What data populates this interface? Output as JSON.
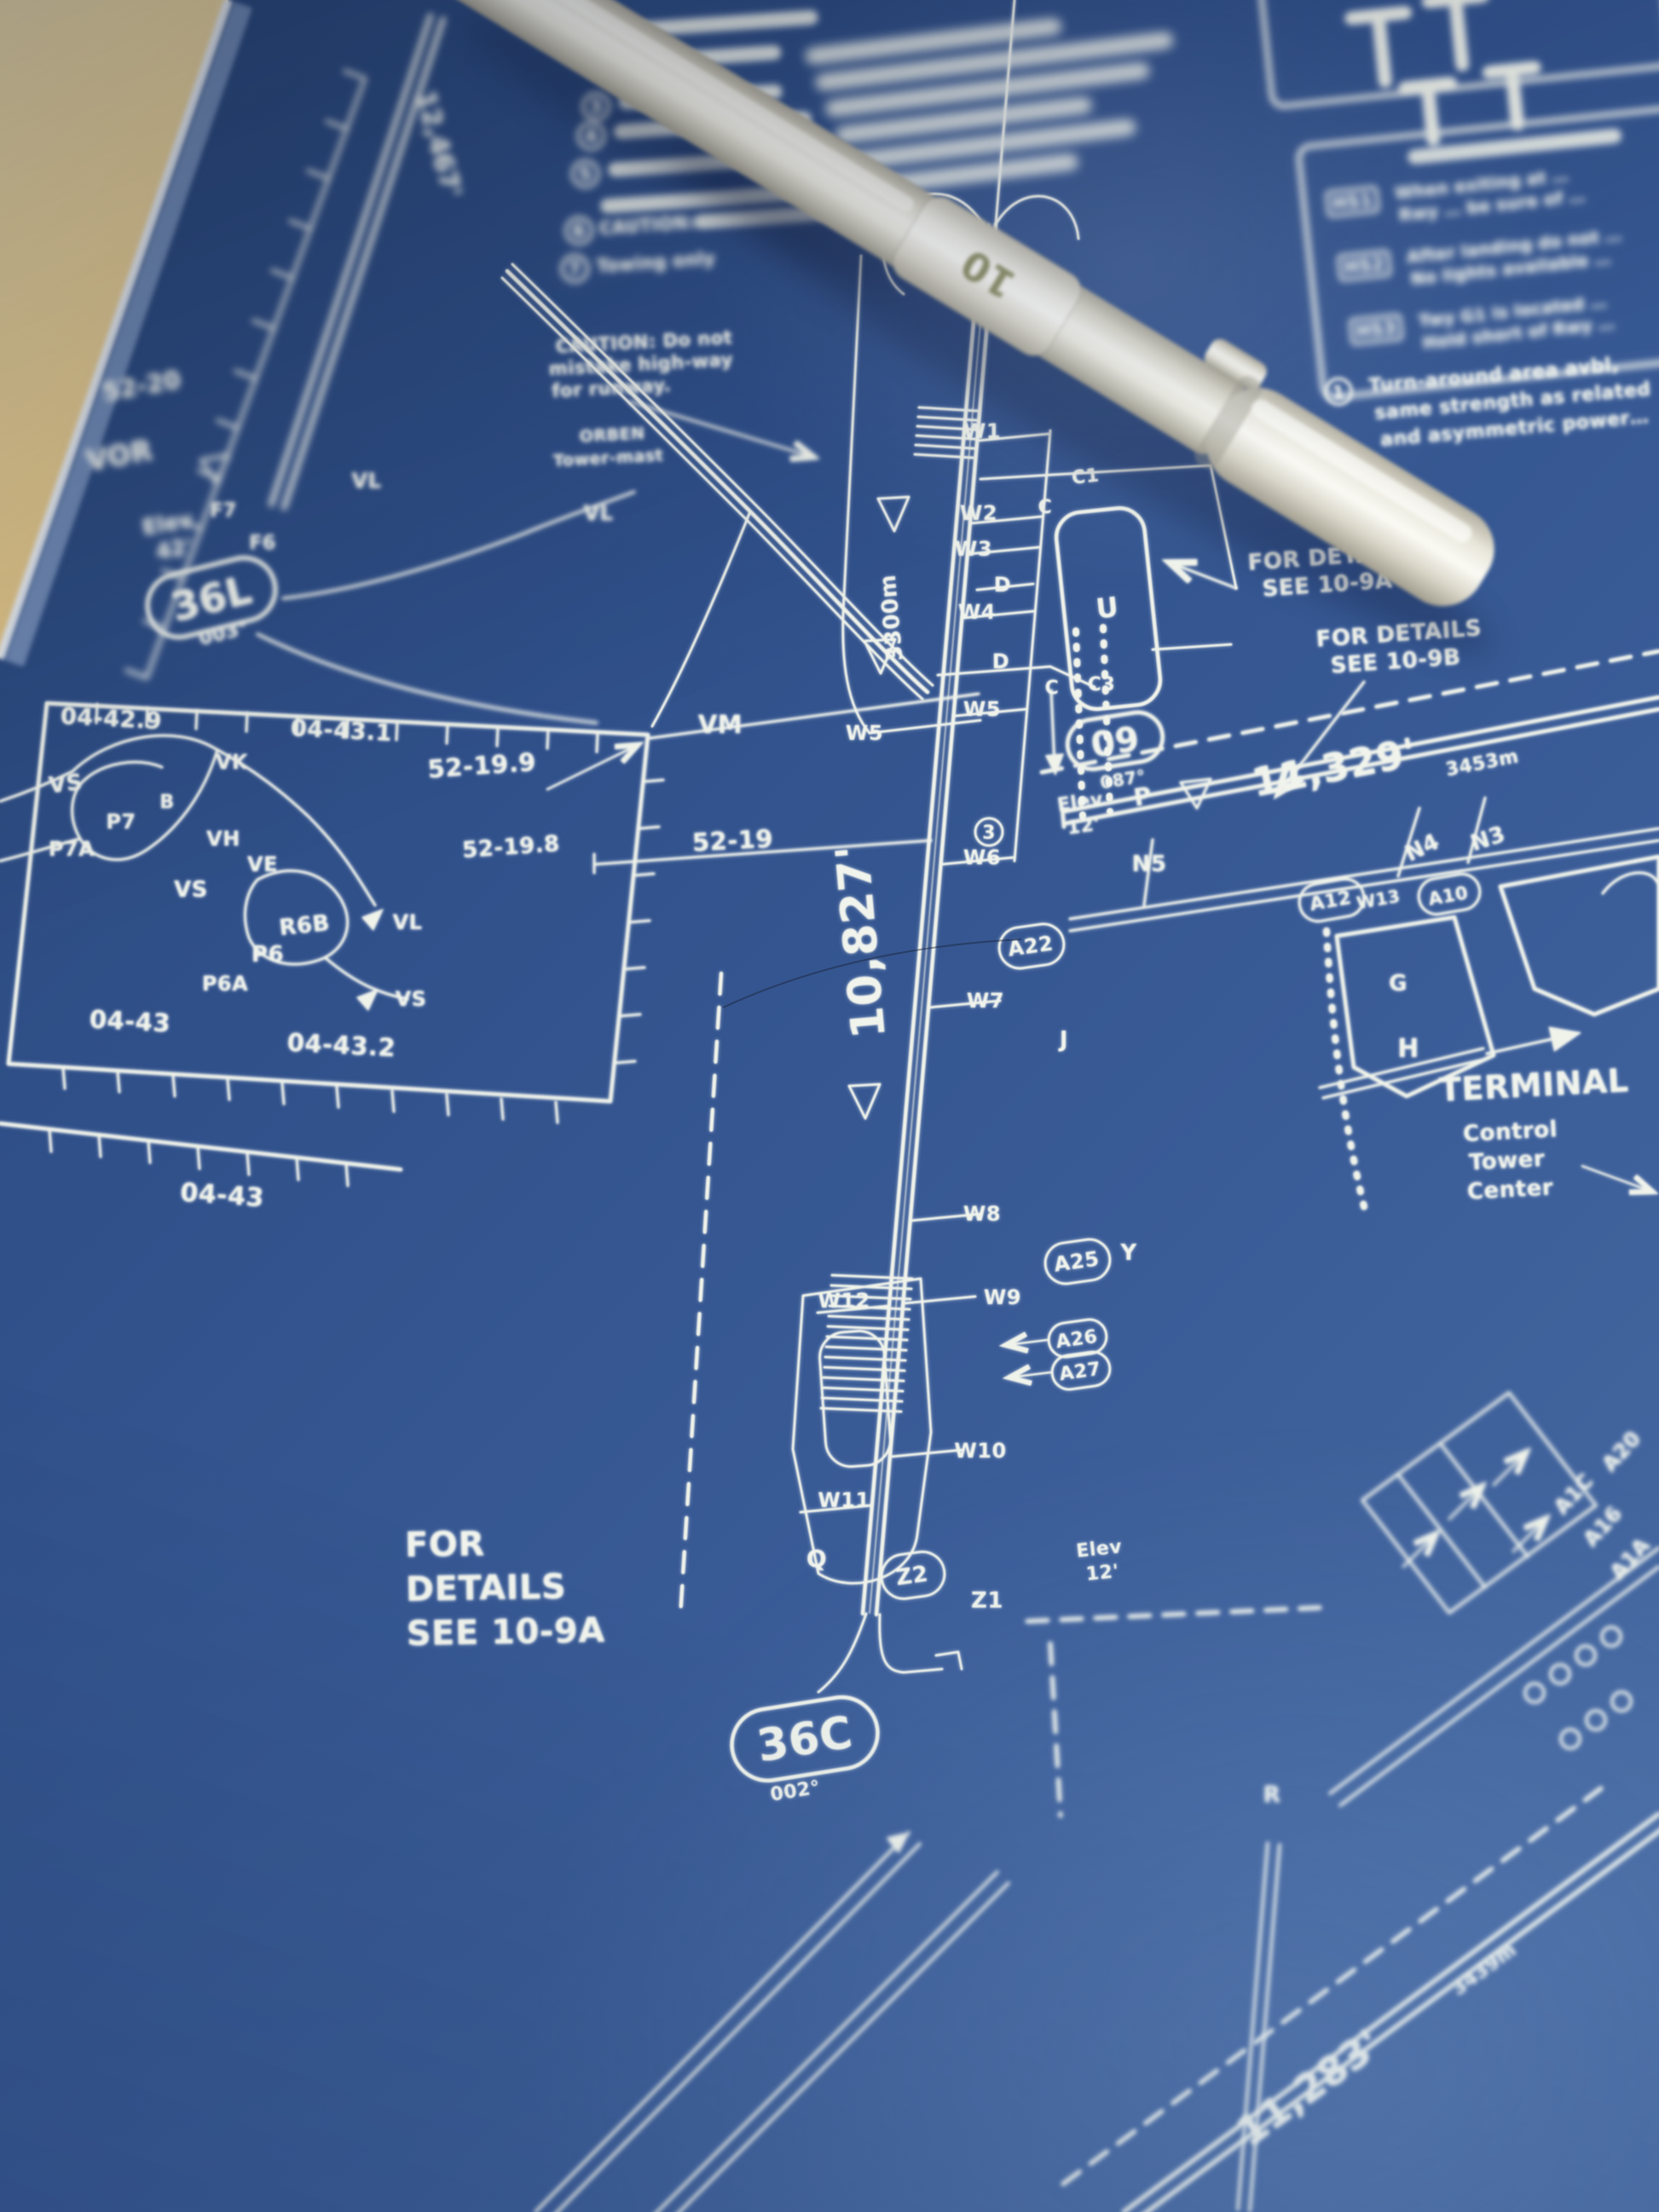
{
  "colors": {
    "paper": "#32528b",
    "ink": "#f0f3ea",
    "wood": "#c79e52",
    "pen_body": "#efecdf",
    "pen_label_ink": "#8b8d62"
  },
  "pen": {
    "label": "10"
  },
  "runways": {
    "r36l_id": "36L",
    "r36l_hdg": "003°",
    "r36l_len": "12,467'",
    "r36c_id": "36C",
    "r36c_hdg": "002°",
    "r36c_len": "10,827'",
    "r36c_rem": "3300m",
    "r09_id": "09",
    "r09_hdg": "087°",
    "r09_len": "11,329'",
    "r09_len_m": "3453m",
    "r06_len": "11,283'",
    "r06_len_m": "3439m"
  },
  "grid": {
    "g52_20": "52-20",
    "g04_42_9": "04-42.9",
    "g04_43_1": "04-43.1",
    "g52_19_9": "52-19.9",
    "g52_19_8": "52-19.8",
    "g52_19": "52-19",
    "g04_43a": "04-43",
    "g04_43_2": "04-43.2",
    "g04_43b": "04-43"
  },
  "nav": {
    "vor": "VOR",
    "elev36l_1": "Elev",
    "elev36l_2": "42'",
    "elev09_1": "Elev",
    "elev09_2": "12'",
    "elevz_1": "Elev",
    "elevz_2": "12'"
  },
  "twy": {
    "w1": "W1",
    "w2": "W2",
    "w3": "W3",
    "w4": "W4",
    "w5_a": "W5",
    "w5_b": "W5",
    "w6": "W6",
    "w7": "W7",
    "w8": "W8",
    "w9": "W9",
    "w10": "W10",
    "w11": "W11",
    "w12": "W12",
    "w13": "W13",
    "u": "U",
    "c1": "C1",
    "c_a": "C",
    "c_b": "C",
    "c3": "C3",
    "d_a": "D",
    "d_b": "D",
    "j": "J",
    "y": "Y",
    "q": "Q",
    "r": "R",
    "g": "G",
    "h": "H",
    "n3": "N3",
    "n4": "N4",
    "n5": "N5",
    "z1": "Z1",
    "z2": "Z2",
    "a12": "A12",
    "a10": "A10",
    "a22": "A22",
    "a25": "A25",
    "a26": "A26",
    "a27": "A27",
    "a20": "A20",
    "a1c": "A1C",
    "a16": "A16",
    "a1a": "A1A",
    "p_sym": "P",
    "vk": "VK",
    "vl_a": "VL",
    "vl_b": "VL",
    "vl_c": "VL",
    "vm": "VM",
    "vs_a": "VS",
    "vs_b": "VS",
    "vs_c": "VS",
    "vh": "VH",
    "ve": "VE",
    "p7": "P7",
    "p7b": "B",
    "p7a": "P7A",
    "p6": "P6",
    "p6a": "P6A",
    "r6b": "R6B",
    "f7": "F7",
    "f6": "F6",
    "note3": "3"
  },
  "notes": {
    "caution_l1": "CAUTION: Do not",
    "caution_l2": "mistake high-way",
    "caution_l3": "for runway.",
    "mast_l1": "ORBEN",
    "mast_l2": "Tower-mast",
    "det_a1": "FOR DETAILS",
    "det_a2": "SEE 10-9A",
    "det_b1": "FOR DETAILS",
    "det_b2": "SEE 10-9B",
    "det_c1": "FOR",
    "det_c2": "DETAILS",
    "det_c3": "SEE 10-9A",
    "terminal": "TERMINAL",
    "ctl1": "Control",
    "ctl2": "Tower",
    "ctl3": "Center",
    "turn_n": "1",
    "turn_l1": "Turn-around area avbl,",
    "turn_l2": "same strength as related",
    "turn_l3": "and asymmetric power…",
    "hs1": "HS1",
    "hs1a": "When exiting at …",
    "hs1b": "Rwy … be sure of …",
    "hs2": "HS2",
    "hs2a": "After landing do not …",
    "hs2b": "No lights available …",
    "hs3": "HS3",
    "hs3a": "Twy G1 is located …",
    "hs3b": "Hold short of Rwy …",
    "n3c": "3",
    "n4c": "4",
    "n5c": "5",
    "n6c": "6",
    "n7c": "7",
    "caution2": "CAUTION:",
    "towing": "Towing only"
  }
}
